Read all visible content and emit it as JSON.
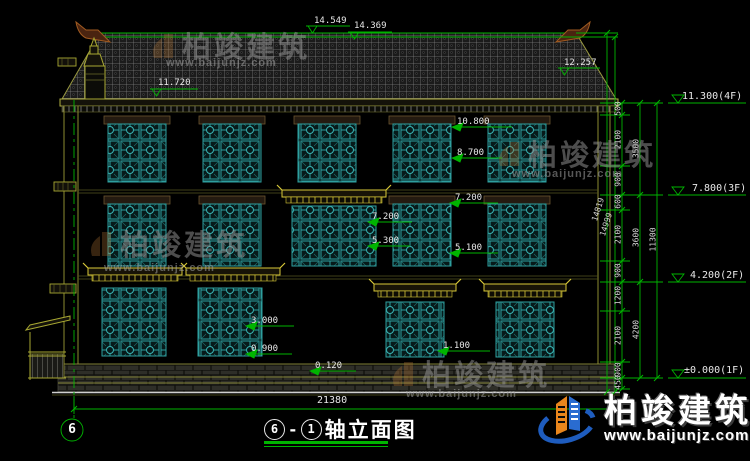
{
  "markers": {
    "top": [
      "14.549",
      "14.369"
    ],
    "roof": "11.720",
    "eave_right": "12.257",
    "floors": [
      "11.300(4F)",
      "7.800(3F)",
      "4.200(2F)",
      "±0.000(1F)"
    ],
    "windows": [
      "10.800",
      "8.700",
      "7.200",
      "5.300",
      "7.200",
      "5.100",
      "3.000",
      "0.900",
      "1.100",
      "0.120"
    ]
  },
  "dimensions": {
    "inner_chain": [
      "500",
      "2100",
      "900",
      "600",
      "2100",
      "900",
      "1200",
      "2100",
      "900",
      "450"
    ],
    "mid_chain": [
      "3500",
      "3600",
      "4200"
    ],
    "overall_height": "11300",
    "ridge_heights": [
      "14819",
      "14999"
    ],
    "overall_width": "21380"
  },
  "title": {
    "axis_from": "6",
    "dash": "-",
    "axis_to": "1",
    "name": "轴立面图"
  },
  "axis_bubble": "6",
  "watermark": {
    "brand": "柏竣建筑",
    "url": "www.baijunjz.com"
  },
  "footer_logo": {
    "brand": "柏竣建筑",
    "url": "www.baijunjz.com"
  },
  "colors": {
    "dimension_green": "#00b400",
    "wall_yellow": "#a8a832",
    "window_teal": "#2e9e9e",
    "canopy_yellow": "#d8c838"
  }
}
